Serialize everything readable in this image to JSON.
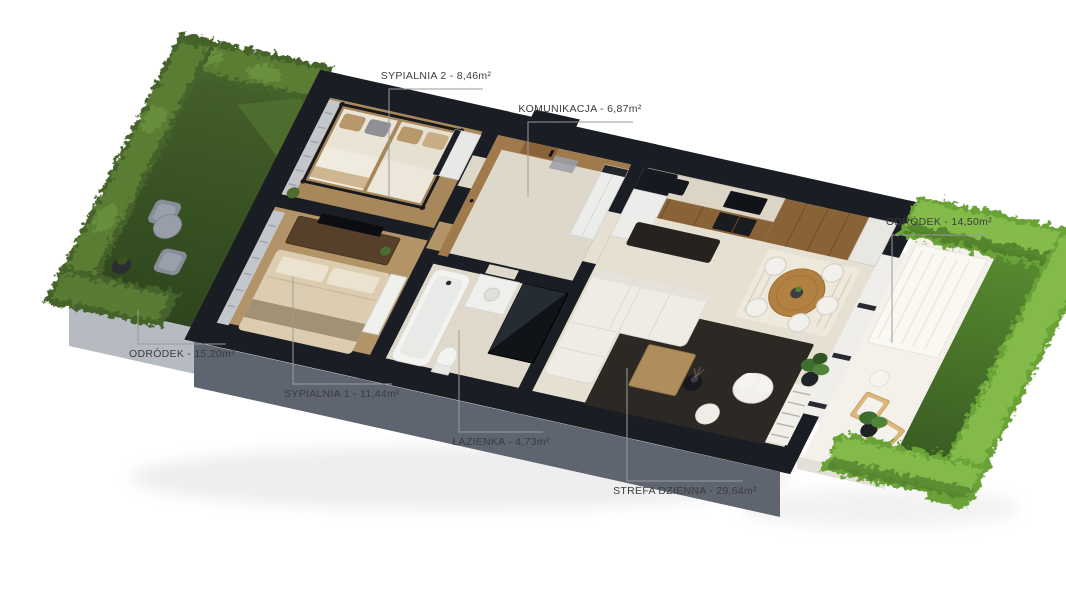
{
  "page": {
    "background": "#ffffff"
  },
  "floor_plan": {
    "type": "3d-apartment-floor-plan-render",
    "labels": [
      {
        "id": "sypialnia-2",
        "text": "SYPIALNIA 2 - 8,46m²"
      },
      {
        "id": "komunikacja",
        "text": "KOMUNIKACJA - 6,87m²"
      },
      {
        "id": "ogrodek-prawy",
        "text": "ODRÓDEK - 14,50m²"
      },
      {
        "id": "ogrodek-lewy",
        "text": "ODRÓDEK - 15,20m²"
      },
      {
        "id": "sypialnia-1",
        "text": "SYPIALNIA 1 - 11,44m²"
      },
      {
        "id": "lazienka",
        "text": "ŁAZIENKA - 4,73m²"
      },
      {
        "id": "strefa-dzienna",
        "text": "STREFA DZIENNA - 29,64m²"
      }
    ],
    "palette": {
      "wall_cut": "#1a1e24",
      "facade": "#5e6470",
      "garden_wall": "#b6bac1",
      "lawn_left": "#36501f",
      "lawn_left_light": "#51702f",
      "hedge_left": "#45622a",
      "hedge_left_light": "#5d8035",
      "hedge_left_hi": "#6e9440",
      "lawn_right": "#47702a",
      "hedge_right": "#6aa238",
      "hedge_right_light": "#86bd4d",
      "hedge_right_dark": "#4e7a2a",
      "floor_tile": "#ded8ca",
      "floor_tile_light": "#e6e0d3",
      "floor_wood": "#a8885a",
      "floor_wood_light": "#b29468",
      "wood_panel": "#a07a4a",
      "cabinet_wood": "#8a6238",
      "counter_top": "#dcd5c6",
      "rug_dark": "#2c2823",
      "sofa_white": "#efece5",
      "bed_beige": "#dccdb0",
      "dining_wood": "#b28040",
      "patio_white": "#f4f1ea",
      "leader_line": "#9b9b9b",
      "label_text": "#3c3c3c"
    }
  }
}
